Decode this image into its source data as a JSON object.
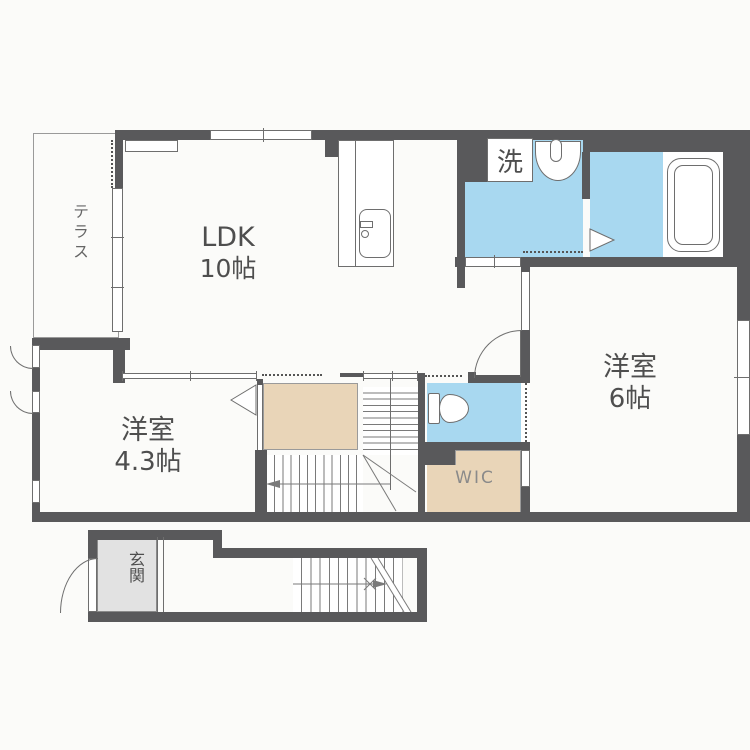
{
  "title": "1LDK+2室 間取り図 (floor plan)",
  "colors": {
    "wall": "#59595b",
    "line": "#6e6e6e",
    "water_area": "#a8d8f0",
    "closet_area": "#e9d5b8",
    "entry_area": "#e2e2e2",
    "text": "#4e4e4e",
    "background": "#fbfbf9"
  },
  "rooms": {
    "terrace": {
      "label": "テラス"
    },
    "ldk": {
      "name": "LDK",
      "size": "10帖"
    },
    "western_room_small": {
      "name": "洋室",
      "size": "4.3帖"
    },
    "western_room_large": {
      "name": "洋室",
      "size": "6帖"
    },
    "laundry": {
      "label": "洗"
    },
    "wic": {
      "label": "WIC"
    },
    "entrance": {
      "label": "玄関"
    }
  }
}
